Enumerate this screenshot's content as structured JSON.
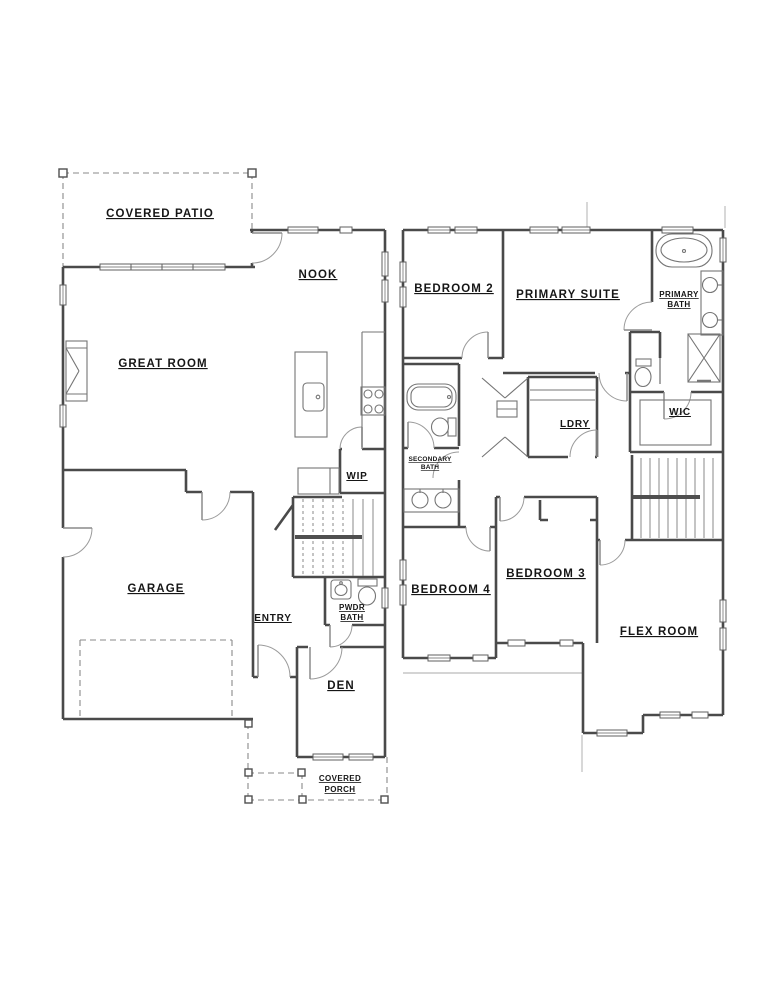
{
  "document": {
    "kind": "residential floor plan, two stories"
  },
  "colors": {
    "background": "#ffffff",
    "wall": "#4a4a4a",
    "fixture_line": "#757575",
    "dashed_line": "#8a8a8a",
    "text": "#161616"
  },
  "floor1": {
    "patio": "COVERED PATIO",
    "nook": "NOOK",
    "great_room": "GREAT ROOM",
    "wip": "WIP",
    "garage": "GARAGE",
    "entry": "ENTRY",
    "pwdr1": "PWDR",
    "pwdr2": "BATH",
    "den": "DEN",
    "porch1": "COVERED",
    "porch2": "PORCH"
  },
  "floor2": {
    "bedroom2": "BEDROOM 2",
    "primary_suite": "PRIMARY SUITE",
    "pbath1": "PRIMARY",
    "pbath2": "BATH",
    "sbath1": "SECONDARY",
    "sbath2": "BATH",
    "ldry": "LDRY",
    "wic": "WIC",
    "bedroom4": "BEDROOM 4",
    "bedroom3": "BEDROOM 3",
    "flex": "FLEX ROOM"
  }
}
